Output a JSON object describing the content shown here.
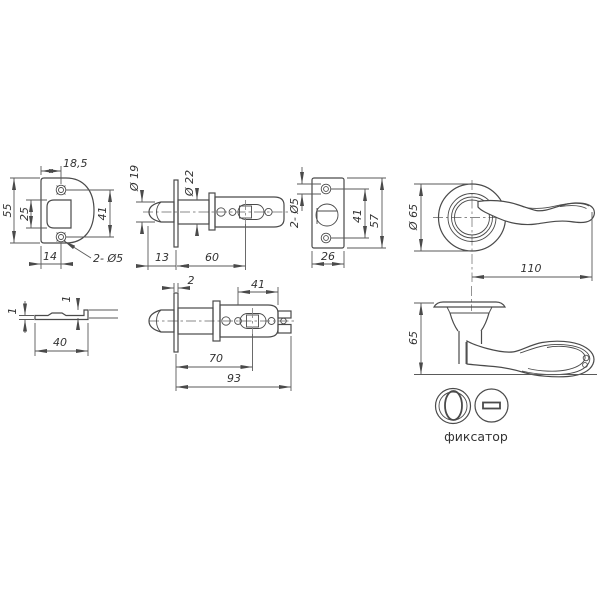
{
  "page": {
    "background": "#ffffff",
    "line_color": "#4a4a4a",
    "text_color": "#333333"
  },
  "views": {
    "strike_plate_front": {
      "dims": {
        "top_width": "18,5",
        "height": "55",
        "opening_height": "25",
        "hole_span": "41",
        "bottom_offset": "14",
        "holes": "2- Ø5"
      }
    },
    "latch_backset_60": {
      "dims": {
        "bolt_diameter": "Ø 19",
        "tube_diameter": "Ø 22",
        "bolt_length": "13",
        "backset": "60"
      }
    },
    "faceplate_front": {
      "dims": {
        "holes": "2- Ø5",
        "hole_span": "41",
        "height": "57",
        "width": "26"
      }
    },
    "handle_front_view": {
      "dims": {
        "rose_diameter": "Ø 65",
        "handle_length": "110"
      }
    },
    "latch_backset_70": {
      "dims": {
        "faceplate_thickness": "2",
        "spindle_span": "41",
        "backset": "70",
        "total_length": "93"
      }
    },
    "strike_plate_side": {
      "dims": {
        "plate_thickness": "1",
        "lip_height": "1",
        "width": "40"
      }
    },
    "handle_side_view": {
      "dims": {
        "height": "65"
      },
      "turn_knob_label": "фиксатор"
    }
  }
}
